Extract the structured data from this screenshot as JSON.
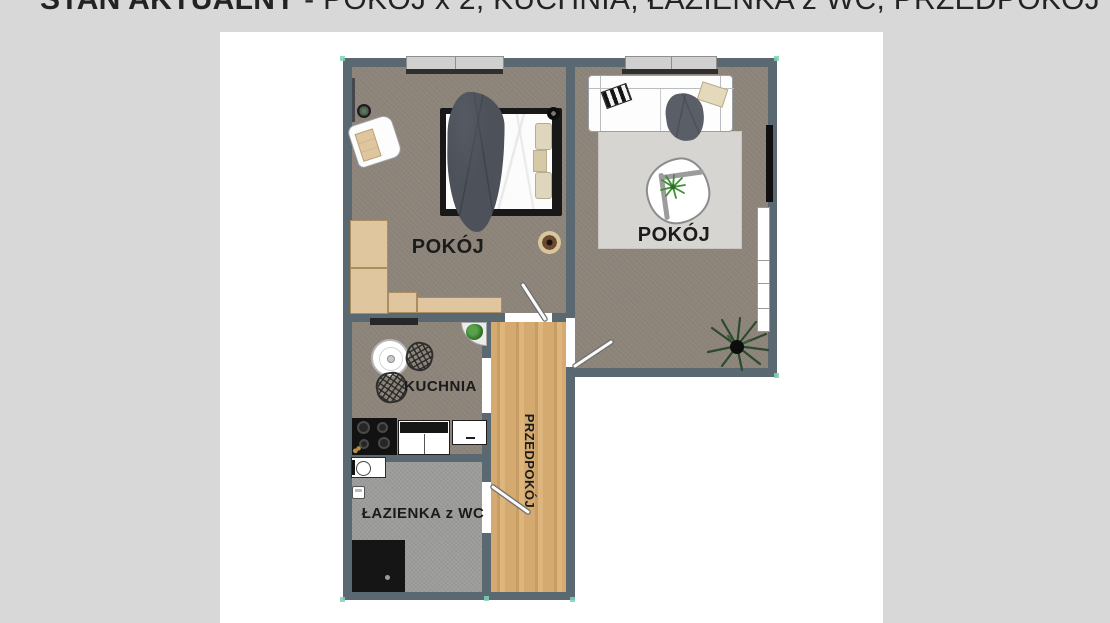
{
  "title": {
    "bold": "STAN AKTUALNY",
    "rest": " - POKÓJ x 2, KUCHNIA, ŁAZIENKA z WC, PRZEDPOKÓJ"
  },
  "rooms": {
    "bedroom_label": "POKÓJ",
    "living_label": "POKÓJ",
    "kitchen_label": "KUCHNIA",
    "bathroom_label": "ŁAZIENKA z WC",
    "hallway_label": "PRZEDPOKÓJ"
  },
  "colors": {
    "bg": "#d8d8d8",
    "panel": "#ffffff",
    "wall": "#5a6872",
    "floor": "#8d847a",
    "bath_floor": "#9c9c9a",
    "wood": "#d4aa71",
    "wood_dark": "#c89d63",
    "wood_light": "#ddb57d",
    "rug": "#d7d5d2",
    "beige": "#e0c69e",
    "beige_border": "#ab8d60",
    "dark_textile": "#4d525a",
    "plant_green": "#3f8f35",
    "plant_dark": "#2c4a2e",
    "teal": "#7fd4b4",
    "ink": "#1b1b1b"
  },
  "icons": {
    "plants": "plant-icon",
    "doors": "door-leaf-icon",
    "appliances": [
      "stove-icon",
      "washing-machine-icon",
      "shower-icon",
      "toilet-icon",
      "tv-icon"
    ]
  }
}
